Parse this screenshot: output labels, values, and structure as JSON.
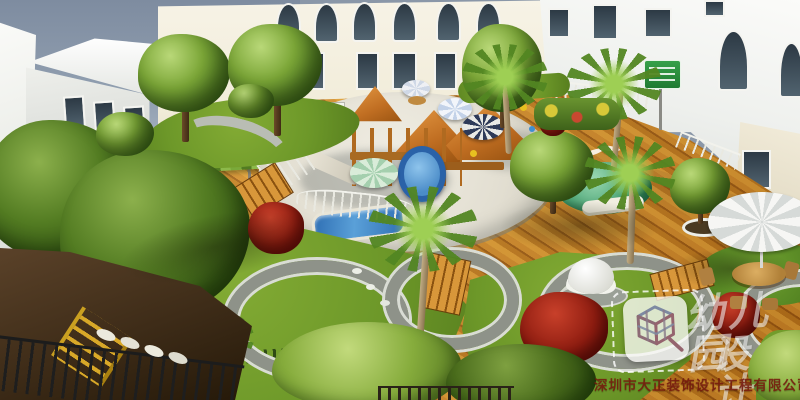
{
  "scene": {
    "description": "Aerial 3D rendering of a kindergarten courtyard: white school buildings around a playground with sand pit, wooden play towers, blue slide, umbrellas, orange wood deck, lawn islands with pebble rings, palms and trees",
    "watermark": {
      "logo_name": "dazheng-cube-logo",
      "title_line1": "幼儿园",
      "title_line2": "设计",
      "company": "深圳市大正装饰设计工程有限公司"
    },
    "palette": {
      "sky": "#7e8ca0",
      "building_white": "#f2f3ef",
      "facade_cream": "#f5f1e2",
      "deck_wood": "#d8902c",
      "sand": "#eae6da",
      "grass": "#6d9829",
      "pebble_ring": "#8e9289",
      "foliage_dark": "#2f5312",
      "red_bush": "#8e1c10",
      "roof_orange": "#c06e22",
      "slide_blue": "#2a62a8",
      "umbrella_navy": "#2e3a58",
      "watermark_white": "rgba(255,255,255,0.55)",
      "company_red": "rgba(118,26,14,0.88)"
    }
  }
}
